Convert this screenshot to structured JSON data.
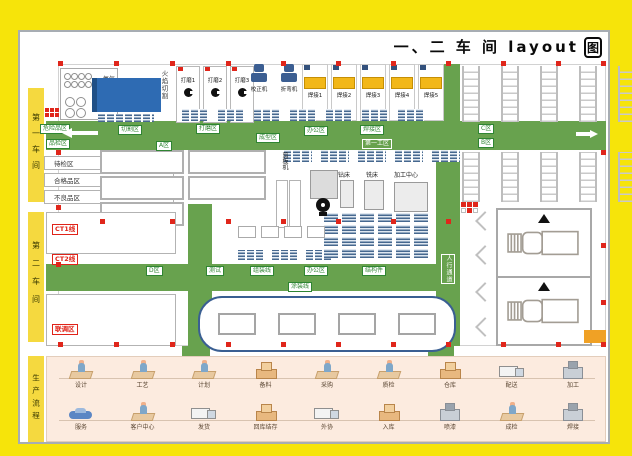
{
  "title": {
    "text": "一、二 车 间 layout",
    "boxed_char": "图"
  },
  "sidebars": {
    "workshop1": "第一车间",
    "workshop2": "第二车间",
    "flow_title": "生产流程"
  },
  "storage": {
    "oxygen": "氧气",
    "acetylene": "乙炔"
  },
  "top_row": {
    "flame_cutting": "火焰切割",
    "grinding_stations": [
      "打磨1",
      "打磨2",
      "打磨3"
    ],
    "forming_machines": [
      {
        "label": "校正机"
      },
      {
        "label": "折弯机"
      }
    ],
    "welding_stations": [
      "焊接1",
      "焊接2",
      "焊接3",
      "焊接4",
      "焊接5"
    ]
  },
  "zones": {
    "hazard": "危险品区",
    "inspection": "品检区",
    "cutting": "切割区",
    "grinding": "打磨区",
    "forming": "成型区",
    "office1": "办公区",
    "welding": "焊接区",
    "work_area1": "第一工区",
    "zone_a": "A区",
    "zone_b": "B区",
    "zone_c": "C区",
    "zone_d": "D区",
    "awaiting_inspection": "待检区",
    "qualified": "合格品区",
    "defective": "不良品区",
    "test": "测试",
    "assembly_line": "组装线",
    "office2": "办公区",
    "structural_parts": "结构件",
    "painting_line": "涂装线",
    "walkway": "人行通道",
    "line_ct1": "CT1线",
    "line_ct2": "CT2线",
    "commissioning": "联调区"
  },
  "machines": {
    "shearing": "剪板机",
    "drill": "钻床",
    "milling": "铣床",
    "machining_center": "加工中心"
  },
  "flow": {
    "row1": [
      {
        "label": "设计",
        "icon": "desk"
      },
      {
        "label": "工艺",
        "icon": "desk"
      },
      {
        "label": "计划",
        "icon": "desk"
      },
      {
        "label": "备料",
        "icon": "boxes"
      },
      {
        "label": "采购",
        "icon": "desk"
      },
      {
        "label": "质检",
        "icon": "desk"
      },
      {
        "label": "仓库",
        "icon": "boxes"
      },
      {
        "label": "配送",
        "icon": "truck"
      },
      {
        "label": "加工",
        "icon": "machine"
      }
    ],
    "row2": [
      {
        "label": "服务",
        "icon": "car"
      },
      {
        "label": "客户中心",
        "icon": "desk"
      },
      {
        "label": "发货",
        "icon": "truck"
      },
      {
        "label": "回库结存",
        "icon": "boxes"
      },
      {
        "label": "外协",
        "icon": "truck"
      },
      {
        "label": "入库",
        "icon": "boxes"
      },
      {
        "label": "喷漆",
        "icon": "machine"
      },
      {
        "label": "成检",
        "icon": "desk"
      },
      {
        "label": "焊接",
        "icon": "machine"
      }
    ]
  }
}
